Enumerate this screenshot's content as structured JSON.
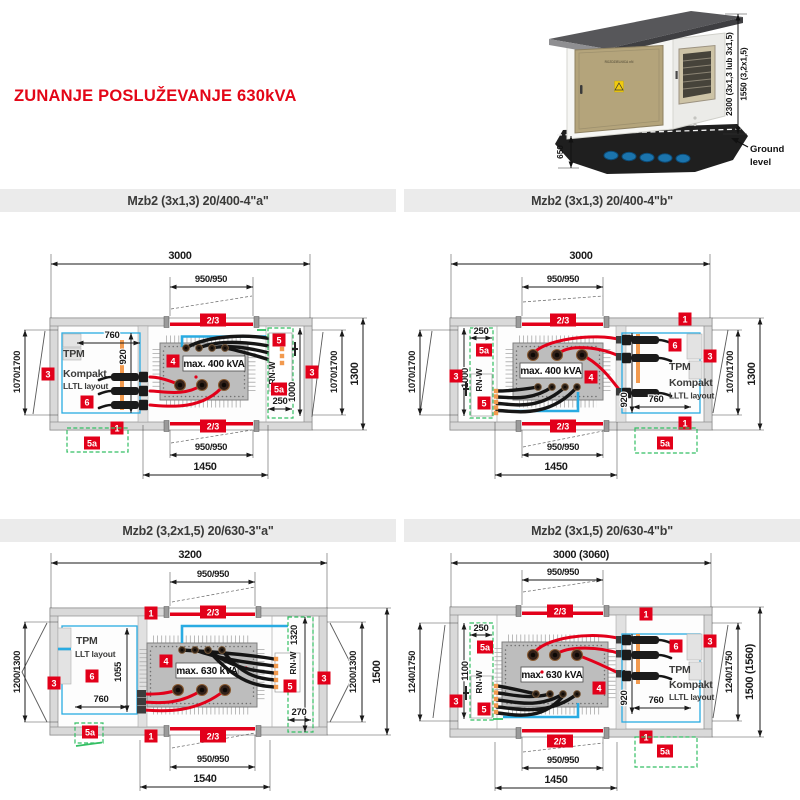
{
  "page_title": "ZUNANJE POSLUŽEVANJE 630kVA",
  "photo": {
    "door_label": "ROZDZIELNICA nN",
    "dim_total_height": "2300 (3x1,3 lub 3x1,5)",
    "dim_cabinet_height": "1550 (3,2x1,5)",
    "dim_base_depth": "650",
    "ground_line1": "Ground",
    "ground_line2": "level"
  },
  "headers": {
    "d1": "Mzb2 (3x1,3) 20/400-4\"a\"",
    "d2": "Mzb2 (3x1,3) 20/400-4\"b\"",
    "d3": "Mzb2 (3,2x1,5) 20/630-3\"a\"",
    "d4": "Mzb2 (3x1,5) 20/630-4\"b\""
  },
  "d1": {
    "dim_total": "3000",
    "dim_door": "950/950",
    "dim_found": "1450",
    "dim_side": "1070/1700",
    "dim_outer": "1300",
    "dim_tpm_w": "760",
    "dim_tpm_h": "920",
    "dim_rn_w": "250",
    "dim_rn_h": "1000",
    "kva": "max. 400 kVA",
    "tpm_line1": "TPM",
    "tpm_line2": "Kompakt",
    "tpm_line3": "LLTL layout",
    "rnw": "RN-W",
    "b1": "1",
    "b23": "2/3",
    "b3": "3",
    "b4": "4",
    "b5": "5",
    "b5a": "5a",
    "b6": "6"
  },
  "d2": {
    "dim_total": "3000",
    "dim_door": "950/950",
    "dim_found": "1450",
    "dim_side": "1070/1700",
    "dim_outer": "1300",
    "dim_tpm_w": "760",
    "dim_tpm_h": "920",
    "dim_rn_w": "250",
    "dim_rn_h": "1000",
    "kva": "max. 400 kVA",
    "tpm_line1": "TPM",
    "tpm_line2": "Kompakt",
    "tpm_line3": "LLTL layout",
    "rnw": "RN-W",
    "b1": "1",
    "b23": "2/3",
    "b3": "3",
    "b4": "4",
    "b5": "5",
    "b5a": "5a",
    "b6": "6"
  },
  "d3": {
    "dim_total": "3200",
    "dim_door": "950/950",
    "dim_found": "1540",
    "dim_side": "1200/1300",
    "dim_outer": "1500",
    "dim_tpm_w": "760",
    "dim_tpm_h": "1055",
    "dim_rn_w": "270",
    "dim_rn_h": "1320",
    "kva": "max. 630 kVA",
    "tpm_line1": "TPM",
    "tpm_line2": "LLT layout",
    "rnw": "RN-W",
    "b1": "1",
    "b23": "2/3",
    "b3": "3",
    "b4": "4",
    "b5": "5",
    "b5a": "5a",
    "b6": "6"
  },
  "d4": {
    "dim_total": "3000 (3060)",
    "dim_door": "950/950",
    "dim_found": "1450",
    "dim_side": "1240/1750",
    "dim_outer": "1500 (1560)",
    "dim_tpm_w": "760",
    "dim_tpm_h": "920",
    "dim_rn_w": "250",
    "dim_rn_h": "1100",
    "kva": "max. 630 kVA",
    "tpm_line1": "TPM",
    "tpm_line2": "Kompakt",
    "tpm_line3": "LLTL layout",
    "rnw": "RN-W",
    "b1": "1",
    "b23": "2/3",
    "b3": "3",
    "b4": "4",
    "b5": "5",
    "b5a": "5a",
    "b6": "6"
  }
}
